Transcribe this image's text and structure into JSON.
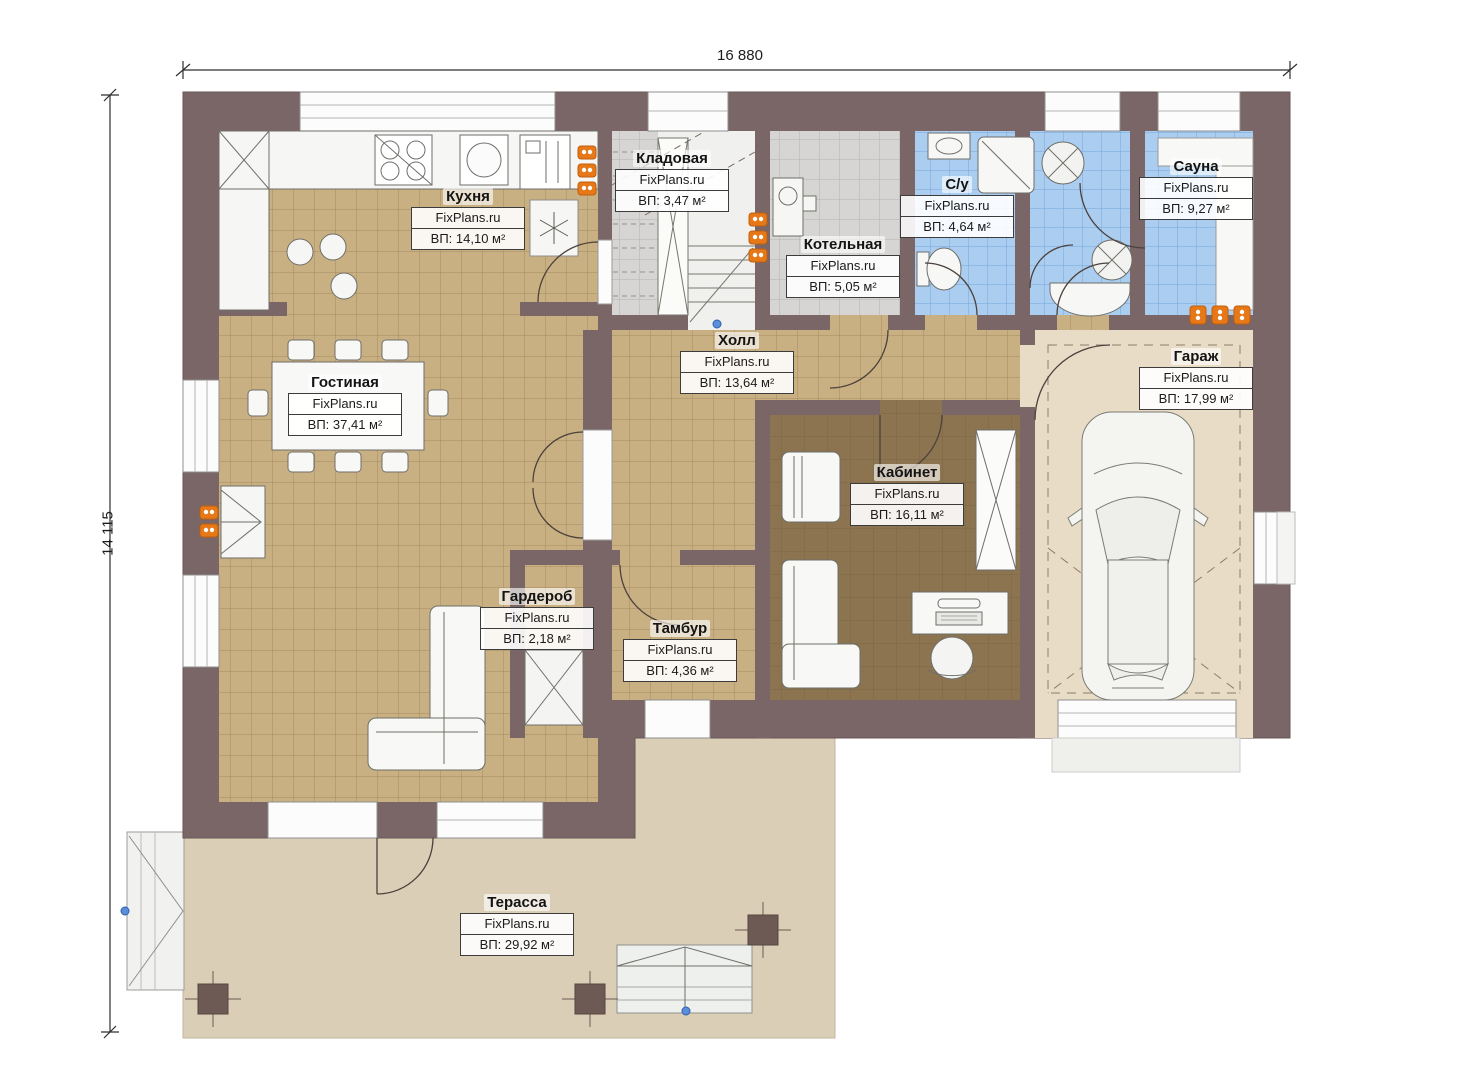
{
  "dimensions": {
    "width": "16 880",
    "height": "14 115"
  },
  "watermark": "FixPlans.ru",
  "rooms": [
    {
      "id": "kitchen",
      "name": "Кухня",
      "watermark": "FixPlans.ru",
      "area": "ВП: 14,10 м²"
    },
    {
      "id": "pantry",
      "name": "Кладовая",
      "watermark": "FixPlans.ru",
      "area": "ВП: 3,47 м²"
    },
    {
      "id": "boiler",
      "name": "Котельная",
      "watermark": "FixPlans.ru",
      "area": "ВП: 5,05 м²"
    },
    {
      "id": "bathroom",
      "name": "С/у",
      "watermark": "FixPlans.ru",
      "area": "ВП: 4,64 м²"
    },
    {
      "id": "sauna",
      "name": "Сауна",
      "watermark": "FixPlans.ru",
      "area": "ВП: 9,27 м²"
    },
    {
      "id": "hall",
      "name": "Холл",
      "watermark": "FixPlans.ru",
      "area": "ВП: 13,64 м²"
    },
    {
      "id": "living",
      "name": "Гостиная",
      "watermark": "FixPlans.ru",
      "area": "ВП: 37,41 м²"
    },
    {
      "id": "garage",
      "name": "Гараж",
      "watermark": "FixPlans.ru",
      "area": "ВП: 17,99 м²"
    },
    {
      "id": "office",
      "name": "Кабинет",
      "watermark": "FixPlans.ru",
      "area": "ВП: 16,11 м²"
    },
    {
      "id": "wardrobe",
      "name": "Гардероб",
      "watermark": "FixPlans.ru",
      "area": "ВП: 2,18 м²"
    },
    {
      "id": "vestibule",
      "name": "Тамбур",
      "watermark": "FixPlans.ru",
      "area": "ВП: 4,36 м²"
    },
    {
      "id": "terrace",
      "name": "Терасса",
      "watermark": "FixPlans.ru",
      "area": "ВП: 29,92 м²"
    }
  ],
  "colors": {
    "wall": "#7a6666",
    "tile_tan": "#c9b083",
    "tile_blue": "#aacdf0",
    "tile_gray": "#d6d5d3",
    "floor_office": "#8b744f",
    "floor_garage": "#e9dcc6",
    "floor_terrace": "#dbceb7",
    "radiator_orange": "#e67817",
    "marker_blue": "#5b8dd9"
  },
  "icons": {
    "car-icon": "top-view car shape",
    "radiator-icon": "orange heating unit",
    "stove-icon": "4-burner cooktop",
    "sink-icon": "round kitchen sink",
    "fridge-icon": "refrigerator with snowflake",
    "stairs-icon": "staircase with treads",
    "fireplace-icon": "corner fireplace",
    "toilet-icon": "toilet top view",
    "shower-icon": "shower tray with diagonal",
    "sofa-icon": "L-shaped sofa",
    "dining-table-icon": "table with 8 chairs",
    "marker-dot-icon": "small blue circle"
  }
}
